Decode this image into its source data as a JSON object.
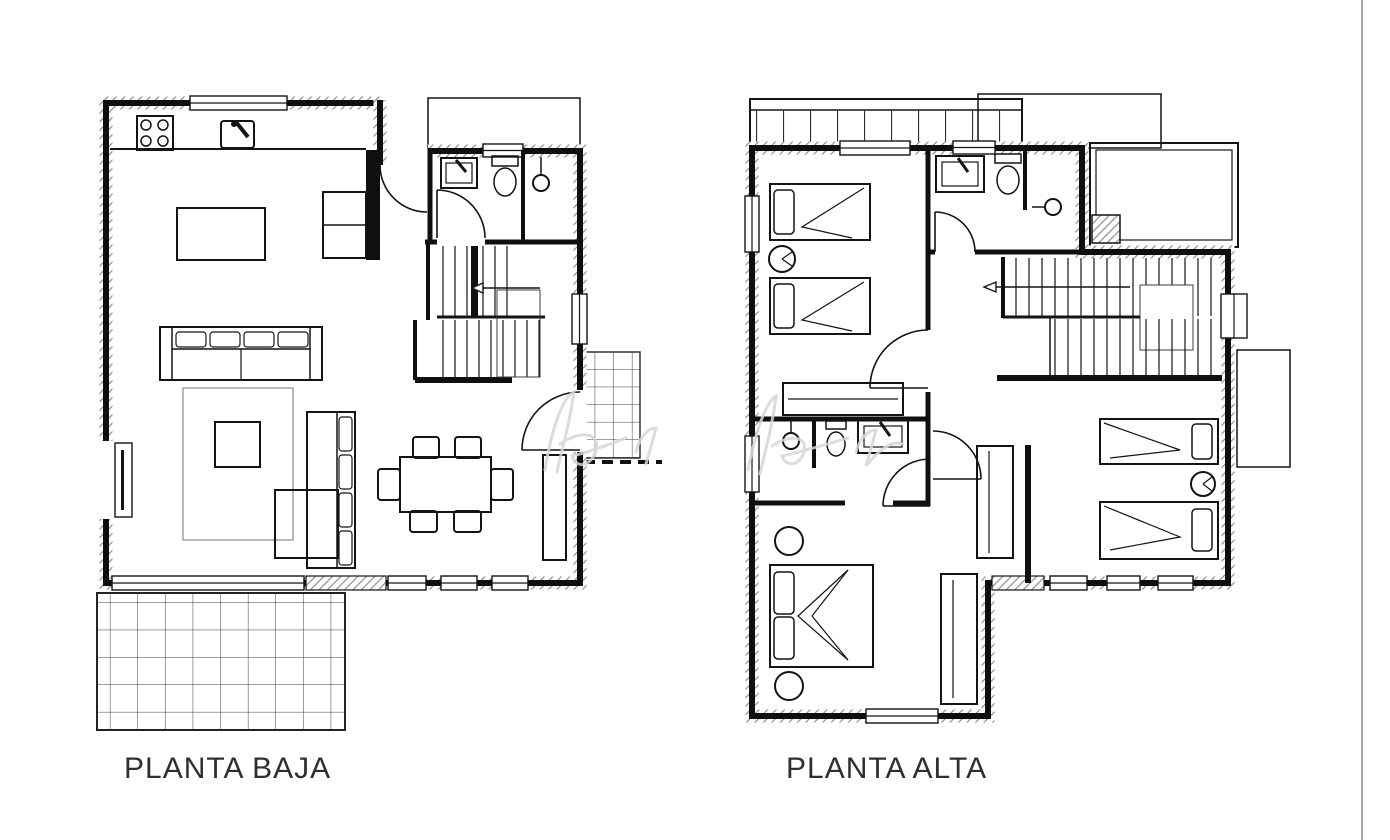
{
  "document": {
    "type": "architectural-floor-plan",
    "sheet_background": "#ffffff",
    "wall_color": "#0f0f0f",
    "hatch_color": "#909090",
    "label_color": "#2f2f2f",
    "sheet_edge_line_color": "#a8a8a8"
  },
  "plans": [
    {
      "id": "planta-baja",
      "label": "PLANTA BAJA",
      "level": "ground-floor",
      "rooms": [
        "kitchen",
        "living-dining-room",
        "bathroom",
        "staircase",
        "entrance-porch",
        "terrace"
      ],
      "features": [
        "stove-4-burners",
        "kitchen-sink",
        "kitchen-island",
        "kitchen-cabinets",
        "sofa-3-seat",
        "sofa-2-seat",
        "coffee-table",
        "tv-table",
        "rug",
        "dining-table",
        "dining-chairs-6",
        "sideboard",
        "washbasin",
        "toilet",
        "shower",
        "stairs-direction-arrow",
        "entrance-door",
        "terrace-tile-grid",
        "porch-tile-grid",
        "windows"
      ]
    },
    {
      "id": "planta-alta",
      "label": "PLANTA ALTA",
      "level": "upper-floor",
      "rooms": [
        "bedroom-twin-left",
        "bathroom",
        "shower-room",
        "hallway",
        "staircase",
        "bedroom-twin-right",
        "bedroom-double",
        "ensuite-bathroom",
        "balcony",
        "roof-terraces"
      ],
      "features": [
        "single-bed-4",
        "double-bed",
        "round-nightstand-4",
        "wardrobe-3",
        "washbasin-2",
        "toilet-2",
        "shower-head-2",
        "stairs-direction-arrow",
        "balcony-railing",
        "windows"
      ]
    }
  ],
  "watermark": {
    "present": true,
    "description": "faint handwritten signature watermark across centre",
    "color": "#d6d6d6"
  }
}
